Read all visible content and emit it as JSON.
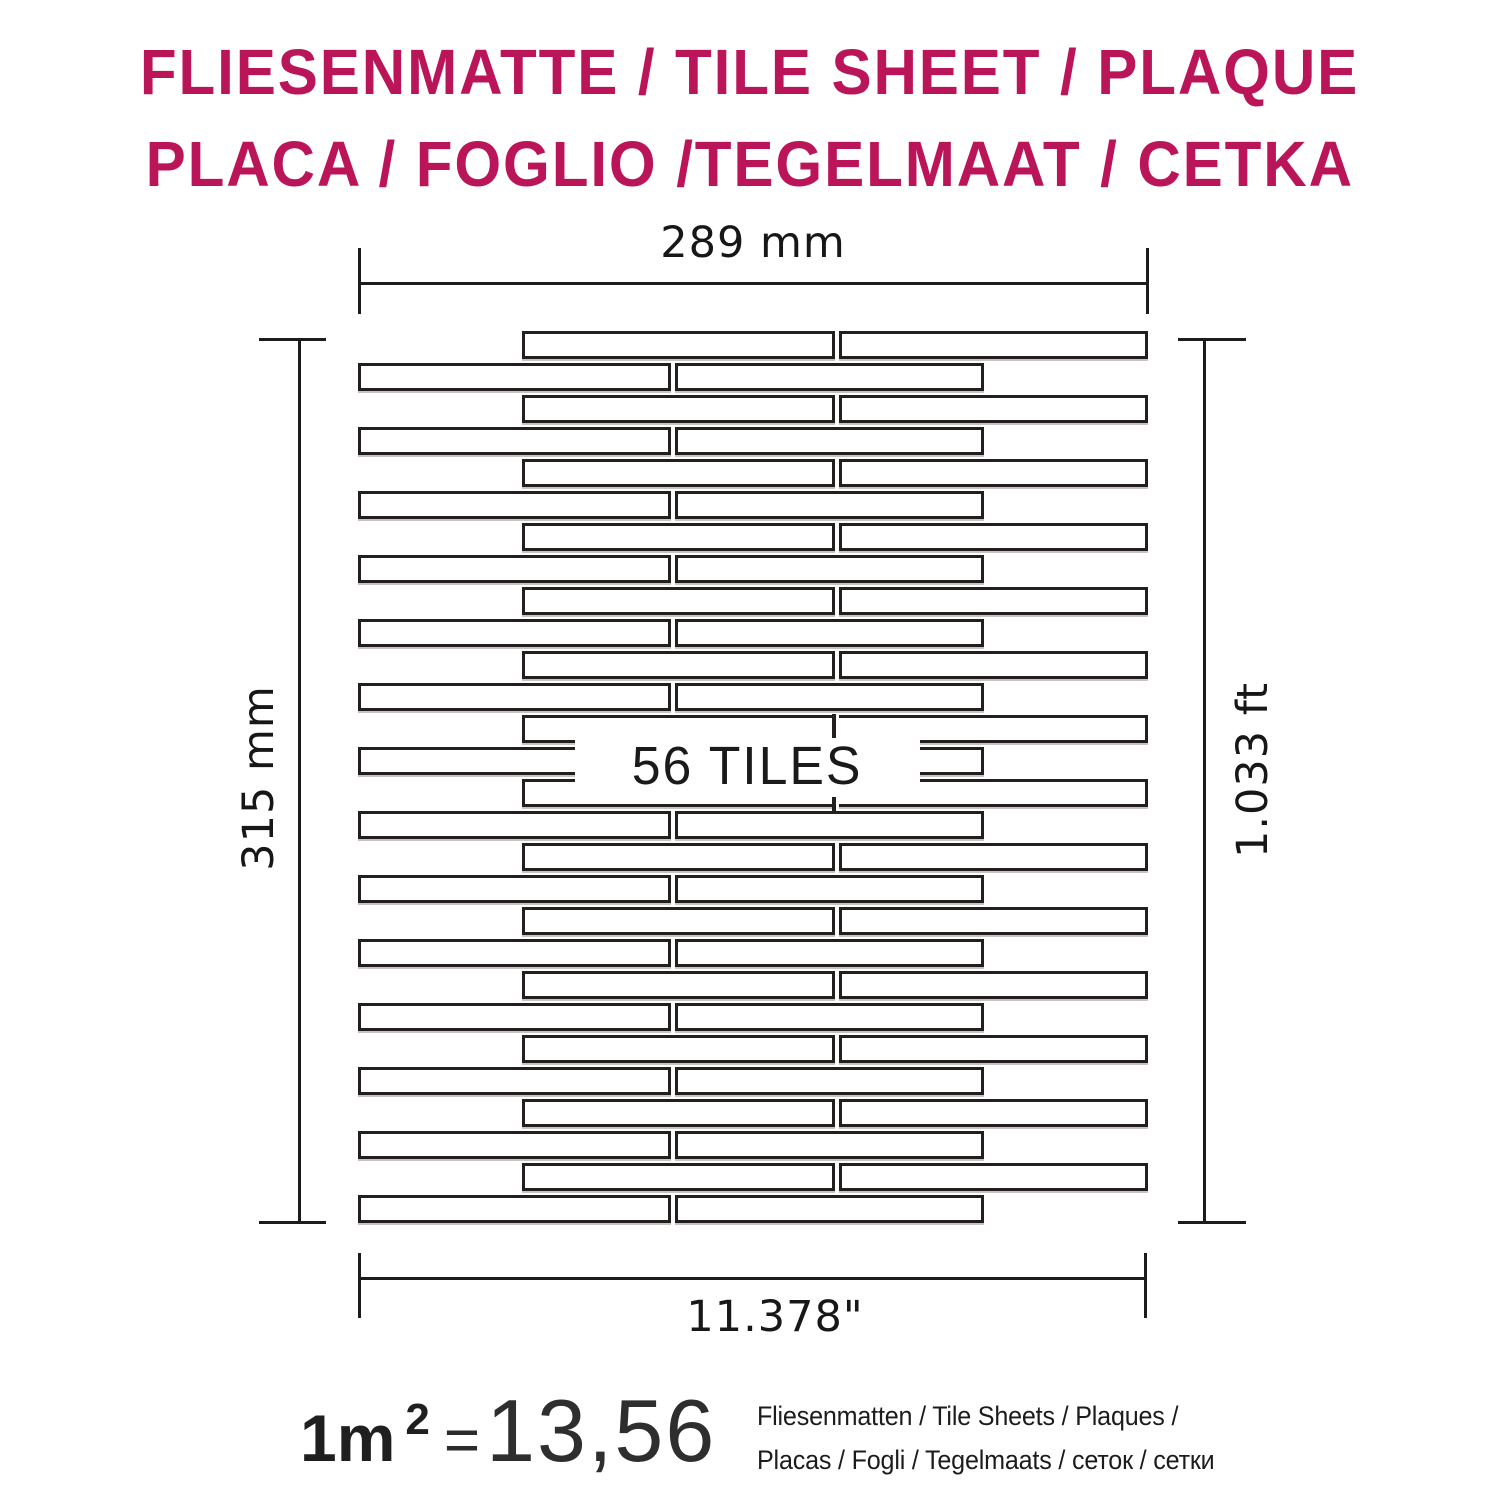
{
  "title": {
    "line1": "FLIESENMATTE / TILE SHEET / PLAQUE",
    "line2": "PLACA / FOGLIO /TEGELMAAT / CETKA",
    "color": "#bb1559"
  },
  "dimensions": {
    "top_metric": "289 mm",
    "left_metric": "315 mm",
    "right_imperial": "1.033 ft",
    "bottom_imperial": "11.378\""
  },
  "sheet": {
    "center_label": "56 TILES",
    "total_tiles": 56,
    "rows": 28,
    "tiles_per_row": 2
  },
  "footer": {
    "area_value": "1m",
    "area_exponent": "2",
    "equals_sign": "=",
    "sheets_per_sqm": "13,56",
    "desc_line1": "Fliesenmatten / Tile Sheets /  Plaques /",
    "desc_line2": "Placas / Fogli / Tegelmaats / сеток /  сетки"
  }
}
